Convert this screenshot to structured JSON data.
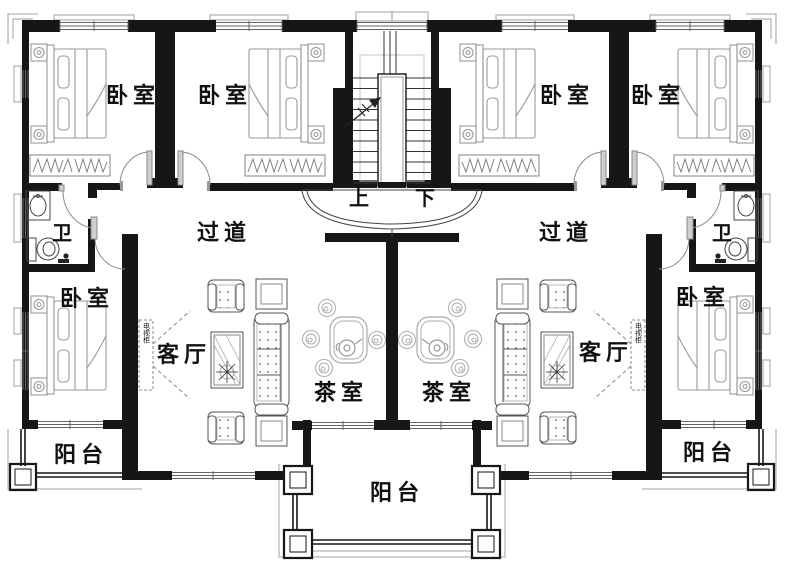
{
  "colors": {
    "wall": "#161616",
    "furniture": "#8a8a8a",
    "window_line": "#666666",
    "door_arc": "#888888",
    "decor_gray": "#b5b5b5",
    "text": "#111111",
    "background": "#ffffff"
  },
  "labels": {
    "bedroom_top_left_outer": "卧室",
    "bedroom_top_left_inner": "卧室",
    "bedroom_top_right_inner": "卧室",
    "bedroom_top_right_outer": "卧室",
    "bedroom_bottom_left": "卧室",
    "bedroom_bottom_right": "卧室",
    "bath_left": "卫",
    "bath_right": "卫",
    "hallway_left": "过道",
    "hallway_right": "过道",
    "stairs_up": "上",
    "stairs_down": "下",
    "living_left": "客厅",
    "living_right": "客厅",
    "tea_left": "茶室",
    "tea_right": "茶室",
    "balcony_left": "阳台",
    "balcony_center": "阳台",
    "balcony_right": "阳台",
    "tv_cabinet_left": "电视柜",
    "tv_cabinet_right": "电视柜"
  }
}
